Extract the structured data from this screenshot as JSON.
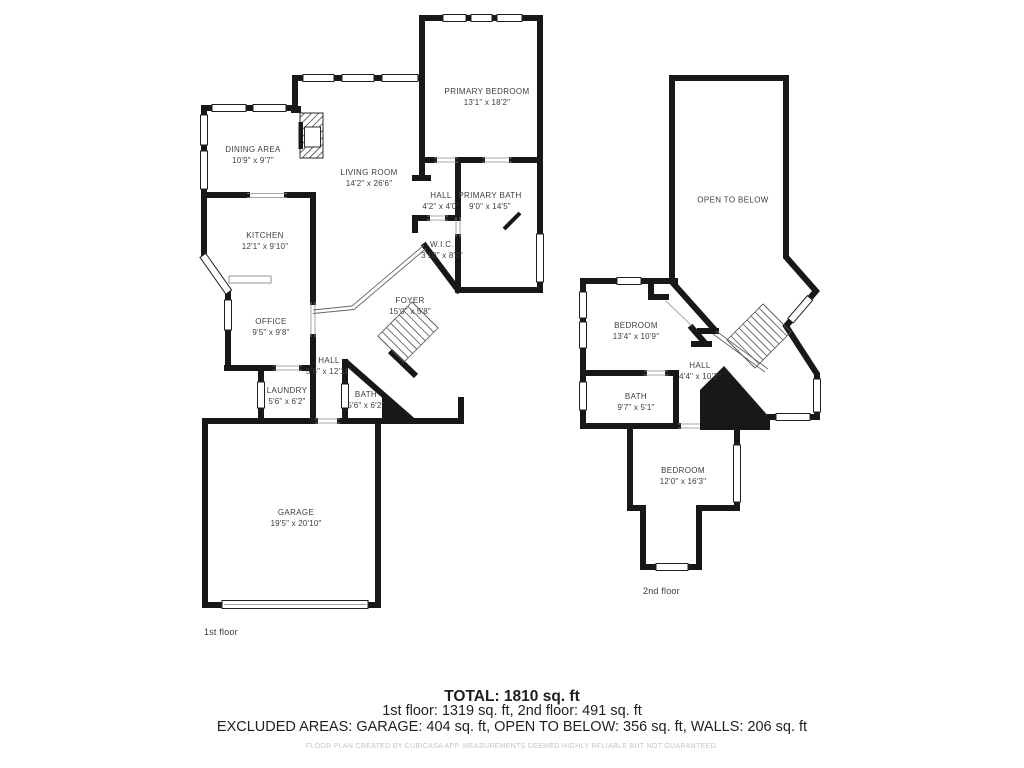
{
  "colors": {
    "background": "#ffffff",
    "wall": "#181818",
    "room_label": "#3d3d3d",
    "summary_text": "#1f1f1f",
    "disclaimer_text": "#c4c4c4"
  },
  "floor1": {
    "label": "1st floor",
    "rooms": [
      {
        "name": "DINING AREA",
        "dims": "10'9\" x 9'7\""
      },
      {
        "name": "LIVING ROOM",
        "dims": "14'2\" x 26'6\""
      },
      {
        "name": "PRIMARY BEDROOM",
        "dims": "13'1\" x 18'2\""
      },
      {
        "name": "HALL",
        "dims": "4'2\" x 4'0\""
      },
      {
        "name": "PRIMARY BATH",
        "dims": "9'0\" x 14'5\""
      },
      {
        "name": "W.I.C.",
        "dims": "3'10\" x 8'0\""
      },
      {
        "name": "KITCHEN",
        "dims": "12'1\" x 9'10\""
      },
      {
        "name": "OFFICE",
        "dims": "9'5\" x 9'8\""
      },
      {
        "name": "HALL",
        "dims": "5'6\" x 12'11\""
      },
      {
        "name": "LAUNDRY",
        "dims": "5'6\" x 6'2\""
      },
      {
        "name": "BATH",
        "dims": "5'6\" x 6'2\""
      },
      {
        "name": "FOYER",
        "dims": "15'0\" x 5'8\""
      },
      {
        "name": "GARAGE",
        "dims": "19'5\" x 20'10\""
      }
    ]
  },
  "floor2": {
    "label": "2nd floor",
    "rooms": [
      {
        "name": "OPEN TO BELOW",
        "dims": ""
      },
      {
        "name": "BEDROOM",
        "dims": "13'4\" x 10'9\""
      },
      {
        "name": "HALL",
        "dims": "4'4\" x 10'2\""
      },
      {
        "name": "BATH",
        "dims": "9'7\" x 5'1\""
      },
      {
        "name": "BEDROOM",
        "dims": "12'0\" x 16'3\""
      }
    ]
  },
  "summary": {
    "total": "TOTAL: 1810 sq. ft",
    "floors": "1st floor: 1319 sq. ft, 2nd floor: 491 sq. ft",
    "excluded": "EXCLUDED AREAS: GARAGE: 404 sq. ft, OPEN TO BELOW: 356 sq. ft, WALLS: 206 sq. ft",
    "disclaimer": "FLOOR PLAN CREATED BY CUBICASA APP. MEASUREMENTS DEEMED HIGHLY RELIABLE BUT NOT GUARANTEED."
  }
}
